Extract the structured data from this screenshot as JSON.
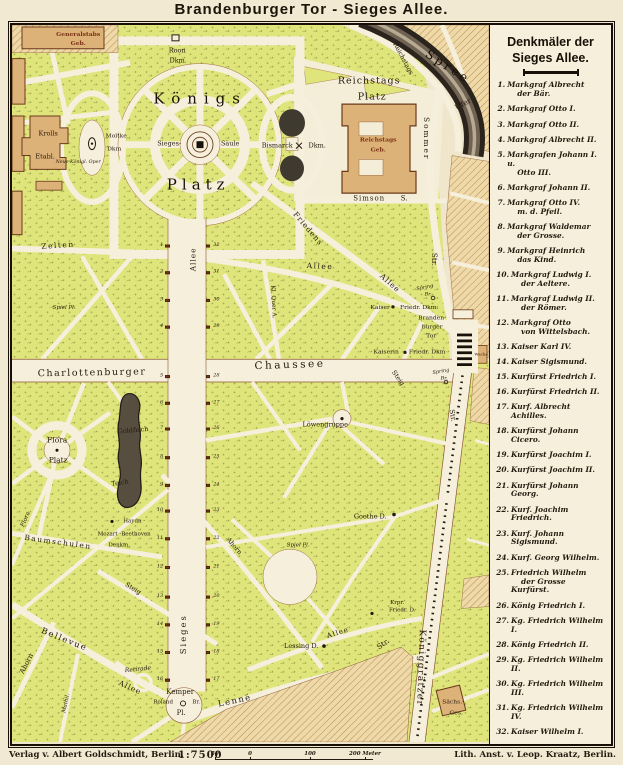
{
  "title": "Brandenburger Tor  -  Sieges Allee.",
  "legend": {
    "heading_line1": "Denkmäler der",
    "heading_line2": "Sieges Allee.",
    "items": [
      {
        "n": "1.",
        "l1": "Markgraf Albrecht",
        "l2": "der Bär."
      },
      {
        "n": "2.",
        "l1": "Markgraf Otto I."
      },
      {
        "n": "3.",
        "l1": "Markgraf Otto II."
      },
      {
        "n": "4.",
        "l1": "Markgraf Albrecht II."
      },
      {
        "n": "5.",
        "l1": "Markgrafen Johann I. u.",
        "l2": "Otto III."
      },
      {
        "n": "6.",
        "l1": "Markgraf Johann II."
      },
      {
        "n": "7.",
        "l1": "Markgraf Otto IV.",
        "l2": "m. d. Pfeil."
      },
      {
        "n": "8.",
        "l1": "Markgraf Waldemar",
        "l2": "der Grosse."
      },
      {
        "n": "9.",
        "l1": "Markgraf Heinrich",
        "l2": "das Kind."
      },
      {
        "n": "10.",
        "l1": "Markgraf Ludwig I.",
        "l2": "der Aeltere."
      },
      {
        "n": "11.",
        "l1": "Markgraf Ludwig II.",
        "l2": "der Römer."
      },
      {
        "n": "12.",
        "l1": "Markgraf Otto",
        "l2": "von Wittelsbach."
      },
      {
        "n": "13.",
        "l1": "Kaiser Karl IV."
      },
      {
        "n": "14.",
        "l1": "Kaiser Sigismund."
      },
      {
        "n": "15.",
        "l1": "Kurfürst Friedrich I."
      },
      {
        "n": "16.",
        "l1": "Kurfürst Friedrich II."
      },
      {
        "n": "17.",
        "l1": "Kurf. Albrecht Achilles."
      },
      {
        "n": "18.",
        "l1": "Kurfürst Johann Cicero."
      },
      {
        "n": "19.",
        "l1": "Kurfürst Joachim I."
      },
      {
        "n": "20.",
        "l1": "Kurfürst Joachim II."
      },
      {
        "n": "21.",
        "l1": "Kurfürst Johann Georg."
      },
      {
        "n": "22.",
        "l1": "Kurf. Joachim Friedrich."
      },
      {
        "n": "23.",
        "l1": "Kurf. Johann Sigismund."
      },
      {
        "n": "24.",
        "l1": "Kurf. Georg Wilhelm."
      },
      {
        "n": "25.",
        "l1": "Friedrich Wilhelm",
        "l2": "der Grosse Kurfürst."
      },
      {
        "n": "26.",
        "l1": "König Friedrich I."
      },
      {
        "n": "27.",
        "l1": "Kg. Friedrich Wilhelm I."
      },
      {
        "n": "28.",
        "l1": "König Friedrich II."
      },
      {
        "n": "29.",
        "l1": "Kg. Friedrich Wilhelm II."
      },
      {
        "n": "30.",
        "l1": "Kg. Friedrich Wilhelm III."
      },
      {
        "n": "31.",
        "l1": "Kg. Friedrich Wilhelm IV."
      },
      {
        "n": "32.",
        "l1": "Kaiser Wilhelm I."
      }
    ]
  },
  "footer": {
    "publisher": "Verlag v. Albert Goldschmidt, Berlin.",
    "scale": "1:7500",
    "scale_ticks": [
      {
        "label": "50",
        "x": 0
      },
      {
        "label": "0",
        "x": 35
      },
      {
        "label": "100",
        "x": 95
      },
      {
        "label": "200 Meter",
        "x": 150
      }
    ],
    "lithographer": "Lith. Anst. v. Leop. Kraatz, Berlin."
  },
  "map": {
    "labels": [
      {
        "t": "Generalstabs",
        "x": 66,
        "y": 10,
        "s": 6,
        "c": "bldg"
      },
      {
        "t": "Geb.",
        "x": 66,
        "y": 19,
        "s": 6,
        "c": "bldg"
      },
      {
        "t": "Roon",
        "x": 165,
        "y": 26,
        "s": 6.5
      },
      {
        "t": "Dkm.",
        "x": 166,
        "y": 36,
        "s": 6.5
      },
      {
        "t": "Königs",
        "x": 188,
        "y": 75,
        "s": 15,
        "ls": 7,
        "c": "big"
      },
      {
        "t": "Platz",
        "x": 186,
        "y": 162,
        "s": 15,
        "ls": 5,
        "c": "big"
      },
      {
        "t": "Krolls",
        "x": 36,
        "y": 110,
        "s": 6.5
      },
      {
        "t": "Etabl.",
        "x": 33,
        "y": 133,
        "s": 6.5
      },
      {
        "t": "Neue Königl. Oper",
        "x": 66,
        "y": 140,
        "s": 4.8,
        "c": "it"
      },
      {
        "t": "Moltke",
        "x": 104,
        "y": 113,
        "s": 6
      },
      {
        "t": "Dkm",
        "x": 102,
        "y": 126,
        "s": 6
      },
      {
        "t": "Sieges-",
        "x": 157,
        "y": 120,
        "s": 6.5
      },
      {
        "t": "Säule",
        "x": 218,
        "y": 120,
        "s": 6.5
      },
      {
        "t": "Bismarck",
        "x": 265,
        "y": 122,
        "s": 6.5
      },
      {
        "t": "Dkm.",
        "x": 305,
        "y": 122,
        "s": 6.5
      },
      {
        "t": "Reichstags",
        "x": 357,
        "y": 57,
        "s": 9.5,
        "c": "med"
      },
      {
        "t": "Platz",
        "x": 360,
        "y": 73,
        "s": 9.5,
        "c": "med"
      },
      {
        "t": "Reichstags",
        "x": 366,
        "y": 117,
        "s": 6,
        "c": "bldg"
      },
      {
        "t": "Geb.",
        "x": 366,
        "y": 127,
        "s": 6,
        "c": "bldg"
      },
      {
        "t": "Simson",
        "x": 357,
        "y": 176,
        "s": 7,
        "ls": 1
      },
      {
        "t": "S.",
        "x": 392,
        "y": 176,
        "s": 7
      },
      {
        "t": "Sommer",
        "x": 414,
        "y": 115,
        "s": 7.5,
        "r": 90,
        "ls": 2
      },
      {
        "t": "Str.",
        "x": 422,
        "y": 237,
        "s": 7.5,
        "r": 90
      },
      {
        "t": "Spree",
        "x": 436,
        "y": 42,
        "s": 12,
        "r": 33,
        "ls": 3,
        "c": "big"
      },
      {
        "t": "Ufer",
        "x": 451,
        "y": 80,
        "s": 7.5,
        "r": -28
      },
      {
        "t": "Reichstags",
        "x": 391,
        "y": 34,
        "s": 6.5,
        "r": 62
      },
      {
        "t": "Zelten",
        "x": 46,
        "y": 223,
        "s": 7.5,
        "r": -4,
        "ls": 1.5
      },
      {
        "t": "Allee",
        "x": 308,
        "y": 244,
        "s": 7.5,
        "r": 3,
        "ls": 1.5
      },
      {
        "t": "Spiel Pl.",
        "x": 52,
        "y": 287,
        "s": 5.5,
        "c": "it"
      },
      {
        "t": "Friedens",
        "x": 296,
        "y": 206,
        "s": 7.5,
        "r": 50,
        "ls": 1
      },
      {
        "t": "Allee",
        "x": 378,
        "y": 261,
        "s": 7.5,
        "r": 42,
        "ls": 1
      },
      {
        "t": "Kl. Quer A.",
        "x": 261,
        "y": 280,
        "s": 6,
        "r": 87
      },
      {
        "t": "Allee",
        "x": 181,
        "y": 237,
        "s": 7.5,
        "r": -90,
        "ls": 1
      },
      {
        "t": "Spring",
        "x": 413,
        "y": 266,
        "s": 5,
        "c": "it",
        "r": -12
      },
      {
        "t": "Br.",
        "x": 416,
        "y": 273,
        "s": 5,
        "c": "it"
      },
      {
        "t": "Kaiser",
        "x": 368,
        "y": 286,
        "s": 6
      },
      {
        "t": "Friedr. Dkm.",
        "x": 407,
        "y": 286,
        "s": 6
      },
      {
        "t": "Branden-",
        "x": 420,
        "y": 297,
        "s": 6
      },
      {
        "t": "burger",
        "x": 420,
        "y": 306,
        "s": 6
      },
      {
        "t": "Tor",
        "x": 419,
        "y": 315,
        "s": 6
      },
      {
        "t": "Wache",
        "x": 469,
        "y": 333,
        "s": 4
      },
      {
        "t": "Kaiserin",
        "x": 374,
        "y": 331,
        "s": 6
      },
      {
        "t": "Friedr. Dkm",
        "x": 415,
        "y": 331,
        "s": 6
      },
      {
        "t": "Spring",
        "x": 429,
        "y": 351,
        "s": 5,
        "c": "it",
        "r": -10
      },
      {
        "t": "Br.",
        "x": 432,
        "y": 358,
        "s": 5,
        "c": "it"
      },
      {
        "t": "Steig",
        "x": 386,
        "y": 357,
        "s": 6.5,
        "r": 55
      },
      {
        "t": "Charlottenburger",
        "x": 80,
        "y": 352,
        "s": 9.5,
        "ls": 1.5,
        "r": -1
      },
      {
        "t": "Chaussee",
        "x": 278,
        "y": 344,
        "s": 10.5,
        "ls": 2.5,
        "r": -2
      },
      {
        "t": "Str.",
        "x": 440,
        "y": 395,
        "s": 7,
        "r": 80
      },
      {
        "t": "Flora",
        "x": 45,
        "y": 420,
        "s": 7.5
      },
      {
        "t": "Platz",
        "x": 46,
        "y": 440,
        "s": 7.5
      },
      {
        "t": "Goldfisch",
        "x": 121,
        "y": 410,
        "s": 6.5,
        "r": -5
      },
      {
        "t": "Teich",
        "x": 108,
        "y": 463,
        "s": 6.5,
        "r": -8
      },
      {
        "t": "Haydn -",
        "x": 122,
        "y": 503,
        "s": 5.5
      },
      {
        "t": "Mozart -Beethoven",
        "x": 112,
        "y": 516,
        "s": 5.5
      },
      {
        "t": "Denkm.",
        "x": 107,
        "y": 527,
        "s": 5.5
      },
      {
        "t": "Löwengruppe",
        "x": 313,
        "y": 404,
        "s": 6.5
      },
      {
        "t": "Goethe D.",
        "x": 358,
        "y": 497,
        "s": 6.5
      },
      {
        "t": "Spiel Pl.",
        "x": 286,
        "y": 527,
        "s": 5.5,
        "c": "it"
      },
      {
        "t": "Ahorn",
        "x": 222,
        "y": 527,
        "s": 6.5,
        "r": 50
      },
      {
        "t": "Steig",
        "x": 121,
        "y": 570,
        "s": 6.5,
        "r": 32
      },
      {
        "t": "Flora",
        "x": 14,
        "y": 500,
        "s": 6,
        "c": "it",
        "r": -68
      },
      {
        "t": "Baumschulen",
        "x": 46,
        "y": 523,
        "s": 7.5,
        "r": 8,
        "ls": 1.5
      },
      {
        "t": "Bellevue",
        "x": 52,
        "y": 622,
        "s": 8.5,
        "r": 22,
        "ls": 1.5
      },
      {
        "t": "Allee",
        "x": 118,
        "y": 670,
        "s": 7.5,
        "r": 25,
        "ls": 1
      },
      {
        "t": "Ahorn",
        "x": 15,
        "y": 646,
        "s": 7,
        "r": -63
      },
      {
        "t": "Mathil.",
        "x": 55,
        "y": 686,
        "s": 5.5,
        "c": "it",
        "r": -78
      },
      {
        "t": "Retirade",
        "x": 126,
        "y": 652,
        "s": 6,
        "c": "it",
        "r": -6
      },
      {
        "t": "Kemper",
        "x": 168,
        "y": 675,
        "s": 7
      },
      {
        "t": "Roland",
        "x": 151,
        "y": 686,
        "s": 5.5
      },
      {
        "t": "Br.",
        "x": 184,
        "y": 686,
        "s": 5.5
      },
      {
        "t": "Pl.",
        "x": 169,
        "y": 696,
        "s": 7
      },
      {
        "t": "Lenné",
        "x": 223,
        "y": 684,
        "s": 8.5,
        "r": -12,
        "ls": 1.5
      },
      {
        "t": "Allee",
        "x": 326,
        "y": 615,
        "s": 7,
        "r": -18,
        "ls": 1
      },
      {
        "t": "Lessing D.",
        "x": 289,
        "y": 628,
        "s": 6.5
      },
      {
        "t": "Krpr.",
        "x": 385,
        "y": 585,
        "s": 5.5
      },
      {
        "t": "Friedr. D.",
        "x": 390,
        "y": 593,
        "s": 5.5
      },
      {
        "t": "Str.",
        "x": 371,
        "y": 626,
        "s": 7.5,
        "r": -35
      },
      {
        "t": "Königgrätzer",
        "x": 408,
        "y": 650,
        "s": 9,
        "r": 92,
        "ls": 1.5
      },
      {
        "t": "Sächs.-",
        "x": 441,
        "y": 685,
        "s": 6
      },
      {
        "t": "Ges.",
        "x": 444,
        "y": 696,
        "s": 6
      },
      {
        "t": "Sieges",
        "x": 172,
        "y": 616,
        "s": 8.5,
        "r": -90,
        "ls": 2
      }
    ],
    "monuments": {
      "west": [
        1,
        2,
        3,
        4,
        5,
        6,
        7,
        8,
        9,
        10,
        11,
        12,
        13,
        14,
        15,
        16
      ],
      "east": [
        32,
        31,
        30,
        29,
        28,
        27,
        26,
        25,
        24,
        23,
        22,
        21,
        20,
        19,
        18,
        17
      ],
      "ys": [
        223,
        250,
        278,
        305,
        355,
        382,
        408,
        437,
        465,
        491,
        519,
        548,
        578,
        606,
        634,
        662
      ]
    }
  },
  "colors": {
    "paper": "#efe5cb",
    "road": "#f6efdb",
    "park_green": "#dfe57b",
    "hatch_block": "#eed9a9",
    "hatch_line": "#c08f55",
    "building": "#ddb278",
    "building_outline": "#6b3a1b",
    "water_dark": "#2b241c",
    "marker_brown": "#7c3a1e",
    "frame_black": "#181006",
    "label_red": "#7a3014"
  }
}
